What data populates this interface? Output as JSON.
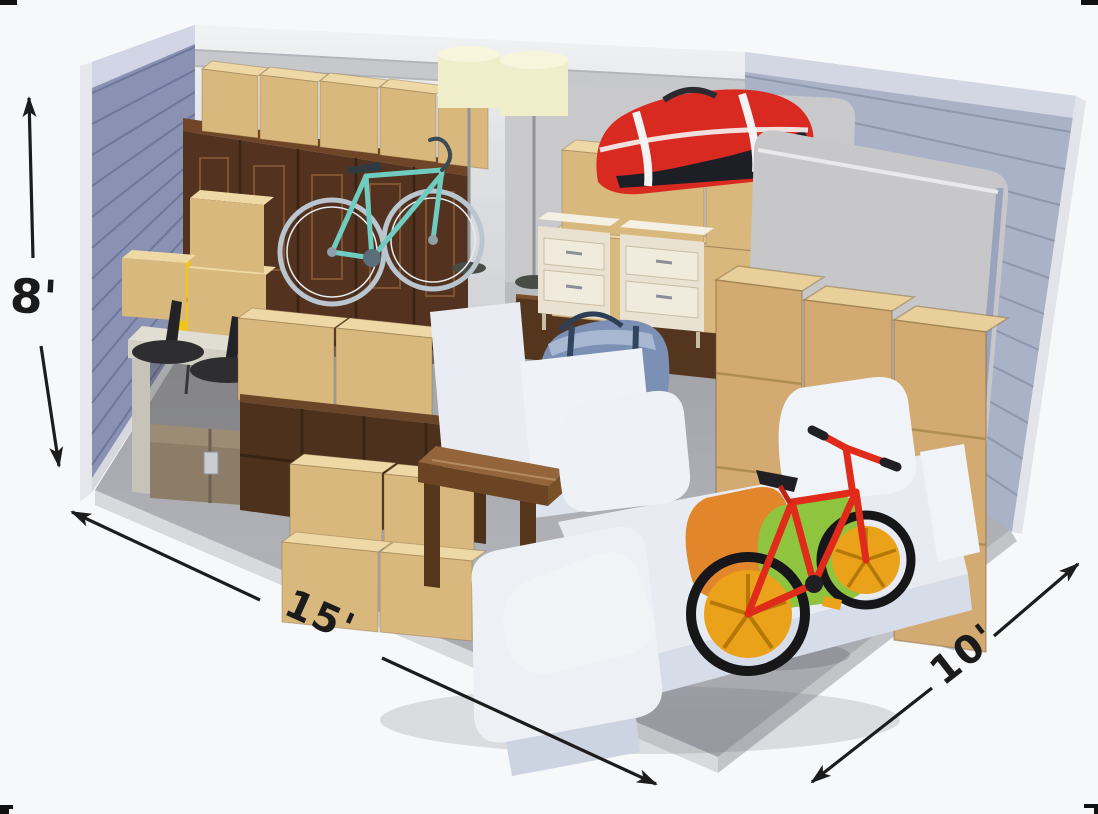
{
  "dimensions": {
    "height": "8'",
    "length": "15'",
    "width": "10'"
  },
  "colors": {
    "background": "#f7f8fa",
    "crop_mark": "#111111",
    "arrow": "#1c1c1c",
    "wall_left": "#8a92b4",
    "wall_back": "#d5d6d9",
    "wall_right": "#a9b2c6",
    "floor": "#abadb3",
    "box_front": "#d9b87e",
    "box_top": "#eed9a6",
    "wardrobe": "#53331f",
    "bike_teal": "#6fccc0",
    "lamp_shade": "#f0edca",
    "duffel_red": "#d92a22",
    "nightstand": "#e9e1d2",
    "mattress": "#c9c9cb",
    "armchair": "#e9edf3",
    "duffel_blue": "#7c90b6",
    "sofa": "#edf0f5",
    "pillow_orange": "#e2862c",
    "pillow_green": "#8fc43e",
    "table_walnut": "#94653a",
    "credenza": "#4e311d",
    "console": "#e0ddd2",
    "stool": "#2e2e31",
    "trunk": "#8d7d68",
    "chair_yellow": "#f2c51d",
    "bike_red": "#e02a1a",
    "wheel_mag_orange": "#eaa21b"
  },
  "items": [
    {
      "name": "cardboard-boxes",
      "color": "#d9b87e"
    },
    {
      "name": "wardrobe",
      "color": "#53331f"
    },
    {
      "name": "road-bike-teal",
      "color": "#6fccc0"
    },
    {
      "name": "floor-lamps",
      "color": "#f0edca"
    },
    {
      "name": "duffel-bag-red",
      "color": "#d92a22"
    },
    {
      "name": "nightstands",
      "color": "#e9e1d2"
    },
    {
      "name": "mattress-back",
      "color": "#c9c9cb"
    },
    {
      "name": "mattress-right",
      "color": "#c7c7c9"
    },
    {
      "name": "armchair-white",
      "color": "#e9edf3"
    },
    {
      "name": "duffel-bag-blue",
      "color": "#7c90b6"
    },
    {
      "name": "sectional-sofa-white",
      "color": "#edf0f5"
    },
    {
      "name": "pillow-orange",
      "color": "#e2862c"
    },
    {
      "name": "pillow-green",
      "color": "#8fc43e"
    },
    {
      "name": "coffee-table-walnut",
      "color": "#94653a"
    },
    {
      "name": "credenza-dark-wood",
      "color": "#4e311d"
    },
    {
      "name": "console-table",
      "color": "#e0ddd2"
    },
    {
      "name": "bar-stools-black",
      "color": "#2e2e31"
    },
    {
      "name": "storage-trunk",
      "color": "#8d7d68"
    },
    {
      "name": "chair-yellow",
      "color": "#f2c51d"
    },
    {
      "name": "bmx-bike-red",
      "color": "#e02a1a"
    }
  ]
}
